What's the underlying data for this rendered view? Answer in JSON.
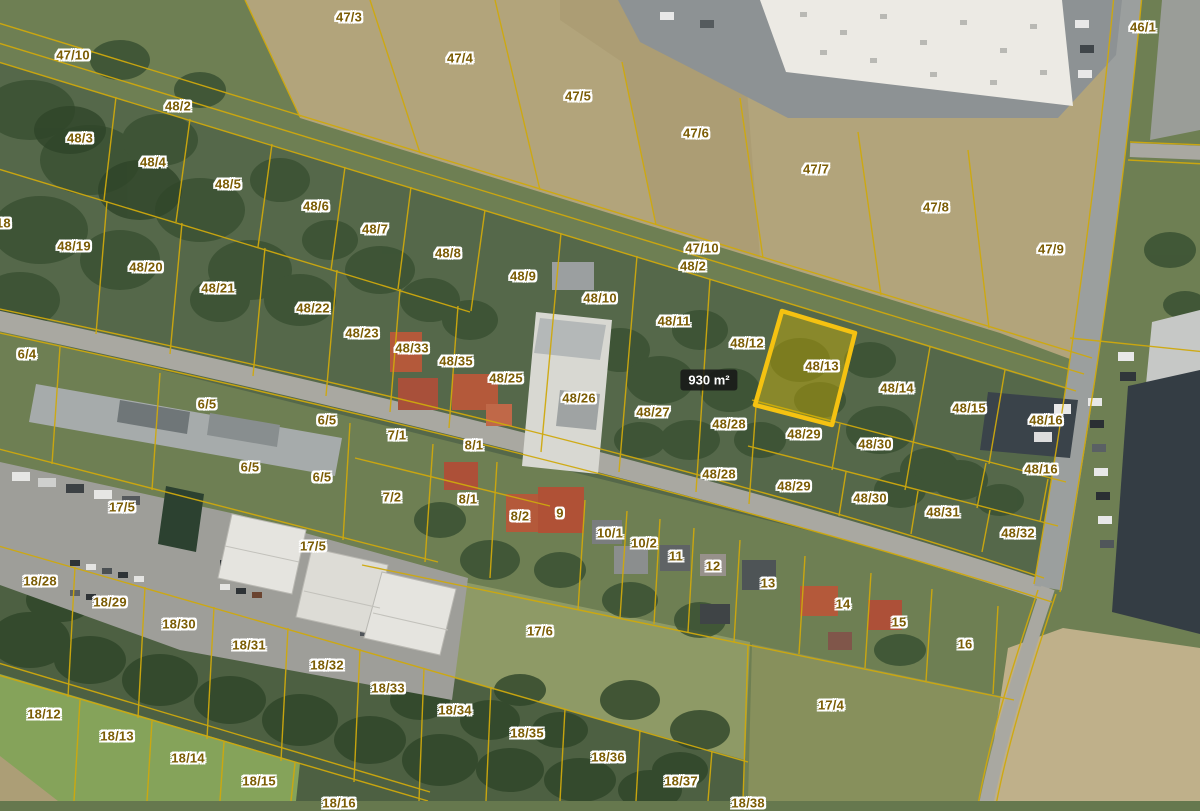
{
  "map": {
    "type": "cadastral-aerial-view",
    "colors": {
      "parcel_line": "#cfa90d",
      "label_text": "#7b5c04",
      "label_halo": "#ffffff",
      "highlight_border": "#f5c211",
      "highlight_fill": "rgba(210,182,0,0.42)",
      "badge_bg": "rgba(22,22,22,0.85)",
      "badge_text_color": "#ffffff"
    },
    "highlight_parcel": {
      "label": "48/13",
      "points": "782,311 855,333 832,425 755,405",
      "area_badge": {
        "text": "930 m²",
        "x": 709,
        "y": 380
      }
    },
    "labels": [
      {
        "text": "47/10",
        "x": 73,
        "y": 55
      },
      {
        "text": "48/2",
        "x": 178,
        "y": 106
      },
      {
        "text": "47/3",
        "x": 349,
        "y": 17
      },
      {
        "text": "47/4",
        "x": 460,
        "y": 58
      },
      {
        "text": "47/5",
        "x": 578,
        "y": 96
      },
      {
        "text": "47/6",
        "x": 696,
        "y": 133
      },
      {
        "text": "47/7",
        "x": 816,
        "y": 169
      },
      {
        "text": "47/8",
        "x": 936,
        "y": 207
      },
      {
        "text": "47/9",
        "x": 1051,
        "y": 249
      },
      {
        "text": "46/1",
        "x": 1143,
        "y": 27
      },
      {
        "text": "48/3",
        "x": 80,
        "y": 138
      },
      {
        "text": "48/4",
        "x": 153,
        "y": 162
      },
      {
        "text": "48/5",
        "x": 228,
        "y": 184
      },
      {
        "text": "48/6",
        "x": 316,
        "y": 206
      },
      {
        "text": "48/7",
        "x": 375,
        "y": 229
      },
      {
        "text": "48/8",
        "x": 448,
        "y": 253
      },
      {
        "text": "48/9",
        "x": 523,
        "y": 276
      },
      {
        "text": "48/10",
        "x": 600,
        "y": 298
      },
      {
        "text": "47/10",
        "x": 702,
        "y": 248
      },
      {
        "text": "48/2",
        "x": 693,
        "y": 266
      },
      {
        "text": "48/11",
        "x": 674,
        "y": 321
      },
      {
        "text": "48/12",
        "x": 747,
        "y": 343
      },
      {
        "text": "48/18",
        "x": -6,
        "y": 223
      },
      {
        "text": "48/19",
        "x": 74,
        "y": 246
      },
      {
        "text": "48/20",
        "x": 146,
        "y": 267
      },
      {
        "text": "48/21",
        "x": 218,
        "y": 288
      },
      {
        "text": "48/22",
        "x": 313,
        "y": 308
      },
      {
        "text": "48/23",
        "x": 362,
        "y": 333
      },
      {
        "text": "6/4",
        "x": 27,
        "y": 354
      },
      {
        "text": "48/33",
        "x": 412,
        "y": 348
      },
      {
        "text": "48/35",
        "x": 456,
        "y": 361
      },
      {
        "text": "48/25",
        "x": 506,
        "y": 378
      },
      {
        "text": "48/26",
        "x": 579,
        "y": 398
      },
      {
        "text": "48/27",
        "x": 653,
        "y": 412
      },
      {
        "text": "48/28",
        "x": 729,
        "y": 424
      },
      {
        "text": "48/13",
        "x": 822,
        "y": 366
      },
      {
        "text": "48/14",
        "x": 897,
        "y": 388
      },
      {
        "text": "48/15",
        "x": 969,
        "y": 408
      },
      {
        "text": "48/16",
        "x": 1046,
        "y": 420
      },
      {
        "text": "48/16",
        "x": 1041,
        "y": 469
      },
      {
        "text": "48/29",
        "x": 804,
        "y": 434
      },
      {
        "text": "48/30",
        "x": 875,
        "y": 444
      },
      {
        "text": "48/28",
        "x": 719,
        "y": 474
      },
      {
        "text": "48/29",
        "x": 794,
        "y": 486
      },
      {
        "text": "48/30",
        "x": 870,
        "y": 498
      },
      {
        "text": "48/31",
        "x": 943,
        "y": 512
      },
      {
        "text": "48/32",
        "x": 1018,
        "y": 533
      },
      {
        "text": "6/5",
        "x": 207,
        "y": 404
      },
      {
        "text": "6/5",
        "x": 327,
        "y": 420
      },
      {
        "text": "6/5",
        "x": 250,
        "y": 467
      },
      {
        "text": "6/5",
        "x": 322,
        "y": 477
      },
      {
        "text": "7/1",
        "x": 397,
        "y": 435
      },
      {
        "text": "8/1",
        "x": 474,
        "y": 445
      },
      {
        "text": "7/2",
        "x": 392,
        "y": 497
      },
      {
        "text": "8/1",
        "x": 468,
        "y": 499
      },
      {
        "text": "8/2",
        "x": 520,
        "y": 516
      },
      {
        "text": "9",
        "x": 560,
        "y": 513
      },
      {
        "text": "10/1",
        "x": 610,
        "y": 533
      },
      {
        "text": "10/2",
        "x": 644,
        "y": 543
      },
      {
        "text": "11",
        "x": 676,
        "y": 556
      },
      {
        "text": "12",
        "x": 713,
        "y": 566
      },
      {
        "text": "13",
        "x": 768,
        "y": 583
      },
      {
        "text": "17/5",
        "x": 122,
        "y": 507
      },
      {
        "text": "17/5",
        "x": 313,
        "y": 546
      },
      {
        "text": "18/28",
        "x": 40,
        "y": 581
      },
      {
        "text": "18/29",
        "x": 110,
        "y": 602
      },
      {
        "text": "18/30",
        "x": 179,
        "y": 624
      },
      {
        "text": "18/31",
        "x": 249,
        "y": 645
      },
      {
        "text": "18/32",
        "x": 327,
        "y": 665
      },
      {
        "text": "18/33",
        "x": 388,
        "y": 688
      },
      {
        "text": "18/12",
        "x": 44,
        "y": 714
      },
      {
        "text": "18/13",
        "x": 117,
        "y": 736
      },
      {
        "text": "18/14",
        "x": 188,
        "y": 758
      },
      {
        "text": "18/15",
        "x": 259,
        "y": 781
      },
      {
        "text": "18/34",
        "x": 455,
        "y": 710
      },
      {
        "text": "18/35",
        "x": 527,
        "y": 733
      },
      {
        "text": "18/36",
        "x": 608,
        "y": 757
      },
      {
        "text": "18/37",
        "x": 681,
        "y": 781
      },
      {
        "text": "18/16",
        "x": 339,
        "y": 803
      },
      {
        "text": "18/38",
        "x": 748,
        "y": 803
      },
      {
        "text": "17/6",
        "x": 540,
        "y": 631
      },
      {
        "text": "17/4",
        "x": 831,
        "y": 705
      },
      {
        "text": "14",
        "x": 843,
        "y": 604
      },
      {
        "text": "15",
        "x": 899,
        "y": 622
      },
      {
        "text": "16",
        "x": 965,
        "y": 644
      }
    ]
  }
}
